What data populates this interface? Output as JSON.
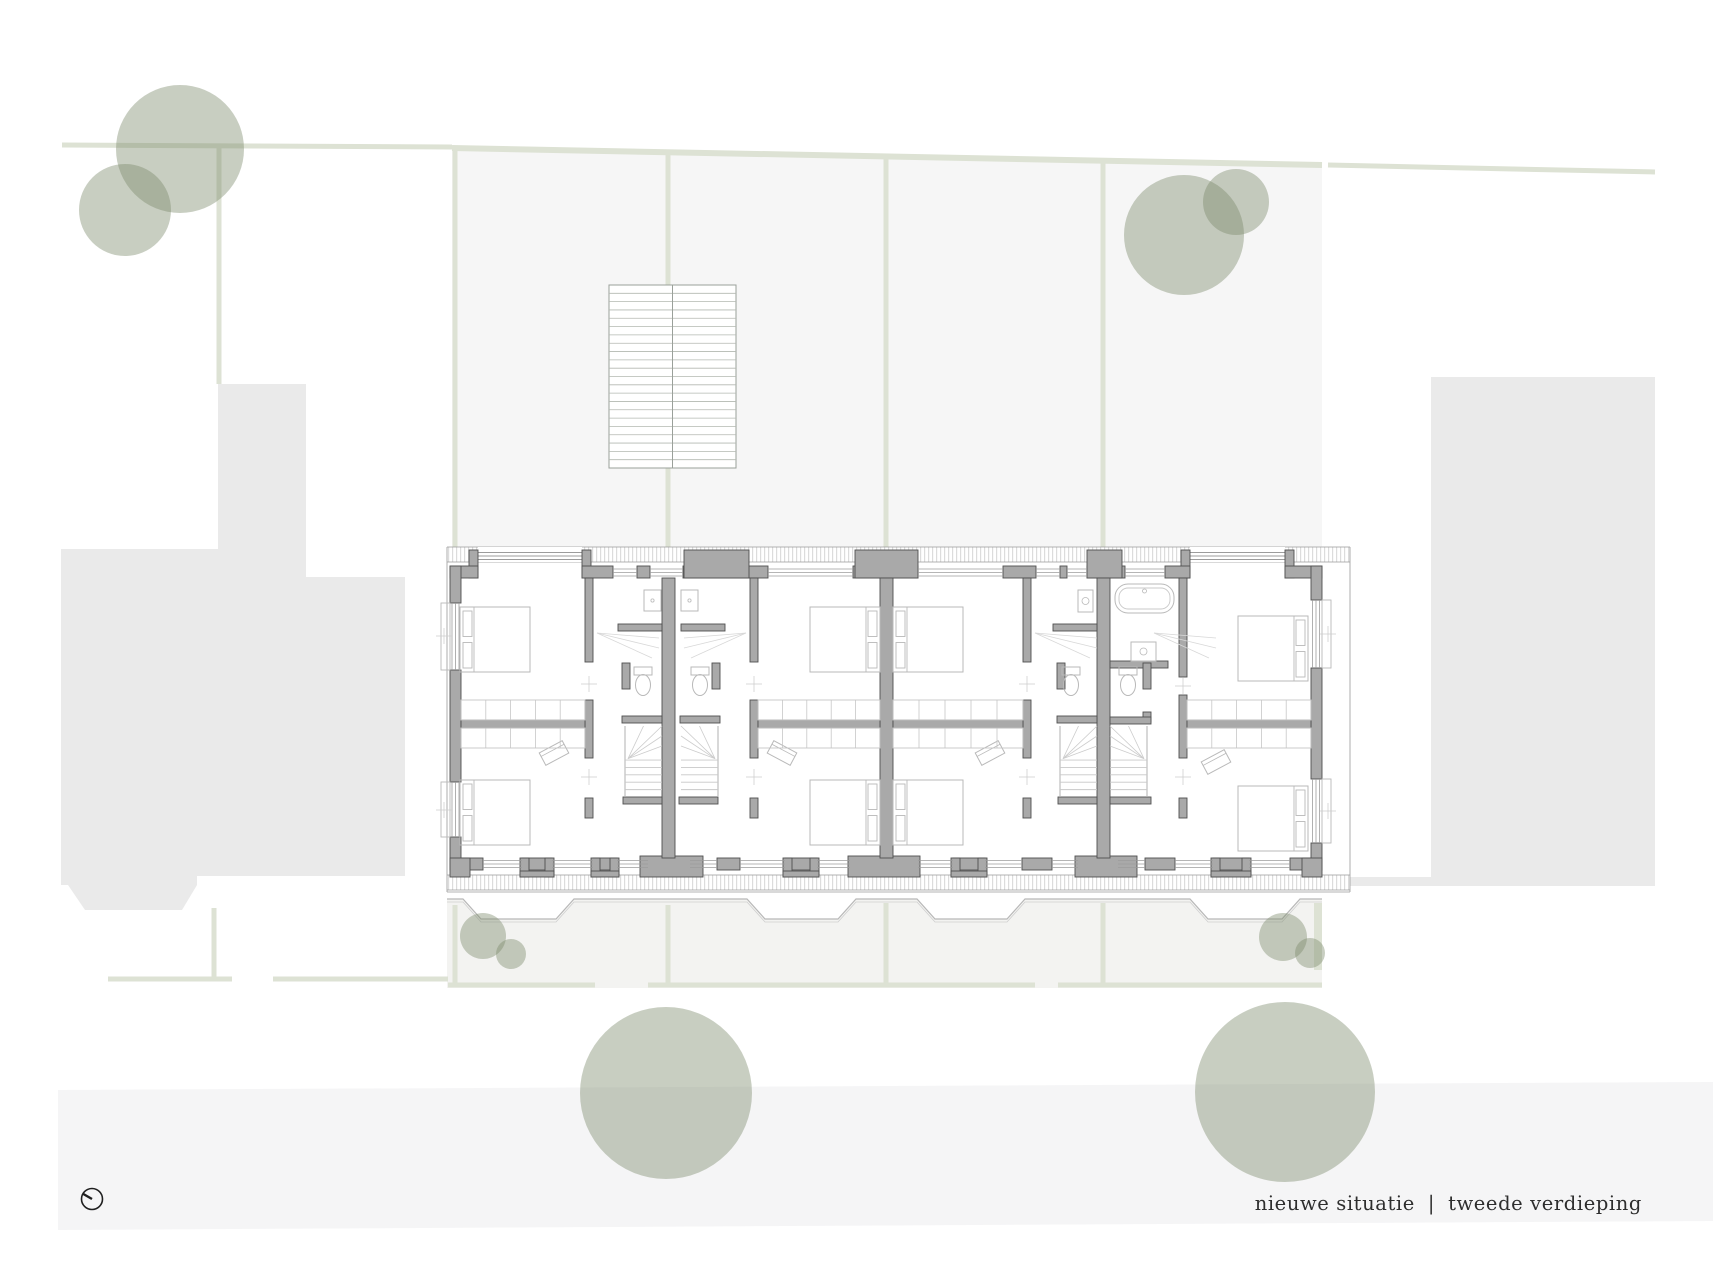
{
  "caption": {
    "left": "nieuwe situatie",
    "sep": "|",
    "right": "tweede verdieping"
  },
  "compass": {
    "cx": 92,
    "cy": 1199,
    "r": 10.5,
    "nx": -9.5,
    "ny": -5.5
  },
  "colors": {
    "plot_fill": "#f6f6f6",
    "building_fill": "#eaeaea",
    "road_fill": "#f5f5f6",
    "strip_fill": "#f3f3f1",
    "line_green": "#dde2d4",
    "tree_green": "rgba(124,139,107,0.42)",
    "wall_fill": "#a9a9a9",
    "wall_stroke": "#4f4f4f",
    "thin": "#b9b9b9",
    "thin2": "#9c9c9c",
    "hatch": "#d0d0d0",
    "text": "#2e2e2e"
  },
  "site": {
    "garden_polygon": [
      [
        452,
        148
      ],
      [
        1322,
        165
      ],
      [
        1322,
        547
      ],
      [
        452,
        547
      ]
    ],
    "left_building_polygon": [
      [
        61,
        549
      ],
      [
        218,
        549
      ],
      [
        218,
        384
      ],
      [
        306,
        384
      ],
      [
        306,
        577
      ],
      [
        405,
        577
      ],
      [
        405,
        876
      ],
      [
        197,
        876
      ],
      [
        197,
        885
      ],
      [
        182,
        910
      ],
      [
        85,
        910
      ],
      [
        68,
        885
      ],
      [
        61,
        885
      ]
    ],
    "right_building": {
      "x": 1431,
      "y": 377,
      "w": 224,
      "h": 509
    },
    "connector": {
      "x": 1328,
      "y": 877,
      "w": 103,
      "h": 9
    },
    "road_polygon": [
      [
        58,
        1090
      ],
      [
        1713,
        1082
      ],
      [
        1713,
        1221
      ],
      [
        58,
        1230
      ]
    ],
    "strip_zigzag": [
      [
        447,
        899
      ],
      [
        463,
        899
      ],
      [
        481,
        919
      ],
      [
        556,
        919
      ],
      [
        574,
        899
      ],
      [
        747,
        899
      ],
      [
        765,
        919
      ],
      [
        838,
        919
      ],
      [
        856,
        899
      ],
      [
        917,
        899
      ],
      [
        935,
        919
      ],
      [
        1007,
        919
      ],
      [
        1025,
        899
      ],
      [
        1190,
        899
      ],
      [
        1208,
        919
      ],
      [
        1282,
        919
      ],
      [
        1300,
        899
      ],
      [
        1322,
        899
      ]
    ],
    "strip_bottom_y": 988,
    "boundary_lines": [
      {
        "x1": 62,
        "y1": 145,
        "x2": 452,
        "y2": 147,
        "w": 5
      },
      {
        "x1": 219,
        "y1": 147,
        "x2": 219,
        "y2": 384,
        "w": 5
      },
      {
        "x1": 452,
        "y1": 148,
        "x2": 1322,
        "y2": 165,
        "w": 6
      },
      {
        "x1": 1328,
        "y1": 165,
        "x2": 1655,
        "y2": 172,
        "w": 5
      },
      {
        "x1": 455,
        "y1": 150,
        "x2": 455,
        "y2": 547,
        "w": 5
      },
      {
        "x1": 668,
        "y1": 152,
        "x2": 668,
        "y2": 285,
        "w": 5
      },
      {
        "x1": 668,
        "y1": 468,
        "x2": 668,
        "y2": 547,
        "w": 5
      },
      {
        "x1": 886,
        "y1": 156,
        "x2": 886,
        "y2": 547,
        "w": 5
      },
      {
        "x1": 1103,
        "y1": 160,
        "x2": 1103,
        "y2": 547,
        "w": 5
      },
      {
        "x1": 455,
        "y1": 905,
        "x2": 455,
        "y2": 985,
        "w": 5
      },
      {
        "x1": 668,
        "y1": 905,
        "x2": 668,
        "y2": 985,
        "w": 5
      },
      {
        "x1": 886,
        "y1": 903,
        "x2": 886,
        "y2": 985,
        "w": 5
      },
      {
        "x1": 1103,
        "y1": 903,
        "x2": 1103,
        "y2": 985,
        "w": 5
      },
      {
        "x1": 1318,
        "y1": 903,
        "x2": 1318,
        "y2": 970,
        "w": 8
      },
      {
        "x1": 448,
        "y1": 985,
        "x2": 595,
        "y2": 985,
        "w": 5
      },
      {
        "x1": 648,
        "y1": 985,
        "x2": 1035,
        "y2": 985,
        "w": 5
      },
      {
        "x1": 1058,
        "y1": 985,
        "x2": 1322,
        "y2": 985,
        "w": 5
      },
      {
        "x1": 108,
        "y1": 979,
        "x2": 232,
        "y2": 979,
        "w": 5
      },
      {
        "x1": 273,
        "y1": 979,
        "x2": 448,
        "y2": 979,
        "w": 5
      },
      {
        "x1": 214,
        "y1": 908,
        "x2": 214,
        "y2": 979,
        "w": 5
      }
    ],
    "ext_stair": {
      "x": 609,
      "y": 285,
      "w": 127,
      "h": 183,
      "treads": 22
    },
    "trees": [
      {
        "cx": 180,
        "cy": 149,
        "r": 64
      },
      {
        "cx": 125,
        "cy": 210,
        "r": 46
      },
      {
        "cx": 1184,
        "cy": 235,
        "r": 60
      },
      {
        "cx": 1236,
        "cy": 202,
        "r": 33
      },
      {
        "cx": 483,
        "cy": 936,
        "r": 23
      },
      {
        "cx": 511,
        "cy": 954,
        "r": 15
      },
      {
        "cx": 1283,
        "cy": 937,
        "r": 24
      },
      {
        "cx": 1310,
        "cy": 953,
        "r": 15
      },
      {
        "cx": 666,
        "cy": 1093,
        "r": 86
      },
      {
        "cx": 1285,
        "cy": 1092,
        "r": 90
      }
    ]
  },
  "plan": {
    "eaves": [
      {
        "x": 447,
        "y": 547,
        "w": 903,
        "h": 15
      },
      {
        "x": 447,
        "y": 875,
        "w": 903,
        "h": 15
      }
    ],
    "edge_lines": [
      {
        "x1": 447,
        "y1": 547,
        "x2": 1350,
        "y2": 547
      },
      {
        "x1": 447,
        "y1": 562,
        "x2": 1350,
        "y2": 562
      },
      {
        "x1": 447,
        "y1": 875,
        "x2": 1350,
        "y2": 875
      },
      {
        "x1": 447,
        "y1": 890,
        "x2": 1350,
        "y2": 890
      },
      {
        "x1": 447,
        "y1": 892,
        "x2": 1350,
        "y2": 892
      },
      {
        "x1": 447,
        "y1": 547,
        "x2": 447,
        "y2": 892
      },
      {
        "x1": 1350,
        "y1": 547,
        "x2": 1350,
        "y2": 892
      }
    ],
    "top_wall": {
      "y": 566,
      "h": 12,
      "segs": [
        [
          450,
          478
        ],
        [
          582,
          613
        ],
        [
          637,
          650
        ],
        [
          683,
          768
        ],
        [
          853,
          918
        ],
        [
          1003,
          1036
        ],
        [
          1060,
          1067
        ],
        [
          1087,
          1125
        ],
        [
          1165,
          1190
        ],
        [
          1285,
          1322
        ]
      ]
    },
    "bottom_wall": {
      "y": 858,
      "h": 12,
      "segs": [
        [
          450,
          483
        ],
        [
          522,
          552
        ],
        [
          593,
          617
        ],
        [
          648,
          690
        ],
        [
          717,
          740
        ],
        [
          785,
          817
        ],
        [
          850,
          918
        ],
        [
          953,
          985
        ],
        [
          1022,
          1052
        ],
        [
          1078,
          1118
        ],
        [
          1145,
          1175
        ],
        [
          1213,
          1249
        ],
        [
          1290,
          1322
        ]
      ]
    },
    "left_wall": {
      "x": 450,
      "w": 11,
      "segs": [
        [
          566,
          603
        ],
        [
          670,
          782
        ],
        [
          837,
          870
        ]
      ]
    },
    "right_wall": {
      "x": 1311,
      "w": 11,
      "segs": [
        [
          566,
          600
        ],
        [
          668,
          779
        ],
        [
          843,
          870
        ]
      ]
    },
    "party_walls": [
      {
        "x": 662,
        "y": 578,
        "w": 13,
        "h": 280
      },
      {
        "x": 880,
        "y": 578,
        "w": 13,
        "h": 280
      },
      {
        "x": 1097,
        "y": 578,
        "w": 13,
        "h": 280
      }
    ],
    "int_walls": [
      {
        "x": 585,
        "y": 578,
        "w": 8,
        "h": 84
      },
      {
        "x": 585,
        "y": 700,
        "w": 8,
        "h": 58
      },
      {
        "x": 585,
        "y": 798,
        "w": 8,
        "h": 20
      },
      {
        "x": 750,
        "y": 578,
        "w": 8,
        "h": 84
      },
      {
        "x": 750,
        "y": 700,
        "w": 8,
        "h": 58
      },
      {
        "x": 750,
        "y": 798,
        "w": 8,
        "h": 20
      },
      {
        "x": 1023,
        "y": 578,
        "w": 8,
        "h": 84
      },
      {
        "x": 1023,
        "y": 700,
        "w": 8,
        "h": 58
      },
      {
        "x": 1023,
        "y": 798,
        "w": 8,
        "h": 20
      },
      {
        "x": 1179,
        "y": 578,
        "w": 8,
        "h": 99
      },
      {
        "x": 1179,
        "y": 695,
        "w": 8,
        "h": 63
      },
      {
        "x": 1179,
        "y": 798,
        "w": 8,
        "h": 20
      },
      {
        "x": 461,
        "y": 720,
        "w": 124,
        "h": 8
      },
      {
        "x": 758,
        "y": 720,
        "w": 122,
        "h": 8
      },
      {
        "x": 893,
        "y": 720,
        "w": 130,
        "h": 8
      },
      {
        "x": 1187,
        "y": 720,
        "w": 124,
        "h": 8
      },
      {
        "x": 618,
        "y": 624,
        "w": 44,
        "h": 7
      },
      {
        "x": 681,
        "y": 624,
        "w": 44,
        "h": 7
      },
      {
        "x": 1053,
        "y": 624,
        "w": 44,
        "h": 7
      },
      {
        "x": 1110,
        "y": 661,
        "w": 58,
        "h": 7
      },
      {
        "x": 622,
        "y": 663,
        "w": 8,
        "h": 26
      },
      {
        "x": 622,
        "y": 716,
        "w": 40,
        "h": 7
      },
      {
        "x": 712,
        "y": 663,
        "w": 8,
        "h": 26
      },
      {
        "x": 680,
        "y": 716,
        "w": 40,
        "h": 7
      },
      {
        "x": 1057,
        "y": 663,
        "w": 8,
        "h": 26
      },
      {
        "x": 1057,
        "y": 716,
        "w": 40,
        "h": 7
      },
      {
        "x": 1143,
        "y": 663,
        "w": 8,
        "h": 26
      },
      {
        "x": 1143,
        "y": 712,
        "w": 8,
        "h": 10
      },
      {
        "x": 1110,
        "y": 717,
        "w": 41,
        "h": 7
      },
      {
        "x": 623,
        "y": 797,
        "w": 39,
        "h": 7
      },
      {
        "x": 679,
        "y": 797,
        "w": 39,
        "h": 7
      },
      {
        "x": 1058,
        "y": 797,
        "w": 39,
        "h": 7
      },
      {
        "x": 1110,
        "y": 797,
        "w": 41,
        "h": 7
      }
    ],
    "chimneys_top": [
      {
        "x": 684,
        "y": 550,
        "w": 65,
        "h": 28
      },
      {
        "x": 855,
        "y": 550,
        "w": 63,
        "h": 28
      },
      {
        "x": 1087,
        "y": 550,
        "w": 35,
        "h": 28
      }
    ],
    "chimneys_bottom": [
      {
        "x": 640,
        "y": 856,
        "w": 63,
        "h": 21
      },
      {
        "x": 848,
        "y": 856,
        "w": 72,
        "h": 21
      },
      {
        "x": 1075,
        "y": 856,
        "w": 62,
        "h": 21
      }
    ],
    "end_stubs": [
      {
        "x": 450,
        "y": 858,
        "w": 20,
        "h": 19
      },
      {
        "x": 1302,
        "y": 858,
        "w": 20,
        "h": 19
      }
    ],
    "piers_bottom": [
      [
        520,
        554
      ],
      [
        591,
        619
      ],
      [
        783,
        819
      ],
      [
        951,
        987
      ],
      [
        1211,
        1251
      ]
    ],
    "dormers": [
      {
        "x": 478,
        "w": 104
      },
      {
        "x": 1190,
        "w": 95
      }
    ],
    "top_windows": [
      [
        613,
        637
      ],
      [
        650,
        683
      ],
      [
        768,
        853
      ],
      [
        918,
        1003
      ],
      [
        1036,
        1060
      ],
      [
        1067,
        1087
      ],
      [
        1125,
        1165
      ]
    ],
    "bottom_windows": [
      [
        483,
        522
      ],
      [
        552,
        593
      ],
      [
        617,
        648
      ],
      [
        690,
        717
      ],
      [
        740,
        785
      ],
      [
        817,
        850
      ],
      [
        918,
        953
      ],
      [
        985,
        1022
      ],
      [
        1052,
        1078
      ],
      [
        1118,
        1145
      ],
      [
        1175,
        1213
      ],
      [
        1249,
        1290
      ]
    ],
    "left_windows": [
      [
        603,
        670
      ],
      [
        782,
        837
      ]
    ],
    "right_windows": [
      [
        600,
        668
      ],
      [
        779,
        843
      ]
    ],
    "sills": [
      {
        "x": 441,
        "y": 603,
        "w": 9,
        "h": 67
      },
      {
        "x": 441,
        "y": 782,
        "w": 9,
        "h": 55
      },
      {
        "x": 1322,
        "y": 600,
        "w": 9,
        "h": 68
      },
      {
        "x": 1322,
        "y": 779,
        "w": 9,
        "h": 64
      }
    ],
    "beds": [
      {
        "x": 460,
        "y": 607,
        "w": 70,
        "h": 65,
        "head": "left"
      },
      {
        "x": 460,
        "y": 780,
        "w": 70,
        "h": 65,
        "head": "left"
      },
      {
        "x": 810,
        "y": 607,
        "w": 70,
        "h": 65,
        "head": "right"
      },
      {
        "x": 810,
        "y": 780,
        "w": 70,
        "h": 65,
        "head": "right"
      },
      {
        "x": 893,
        "y": 607,
        "w": 70,
        "h": 65,
        "head": "left"
      },
      {
        "x": 893,
        "y": 780,
        "w": 70,
        "h": 65,
        "head": "left"
      },
      {
        "x": 1238,
        "y": 616,
        "w": 70,
        "h": 65,
        "head": "right"
      },
      {
        "x": 1238,
        "y": 786,
        "w": 70,
        "h": 65,
        "head": "right"
      }
    ],
    "desks": [
      {
        "cx": 554,
        "cy": 753,
        "rot": -28
      },
      {
        "cx": 782,
        "cy": 753,
        "rot": 28
      },
      {
        "cx": 990,
        "cy": 753,
        "rot": -28
      },
      {
        "cx": 1216,
        "cy": 762,
        "rot": -28
      }
    ],
    "closets": [
      {
        "x": 461,
        "y": 700,
        "w": 124,
        "h": 20
      },
      {
        "x": 461,
        "y": 728,
        "w": 124,
        "h": 20
      },
      {
        "x": 758,
        "y": 700,
        "w": 122,
        "h": 20
      },
      {
        "x": 758,
        "y": 728,
        "w": 122,
        "h": 20
      },
      {
        "x": 893,
        "y": 700,
        "w": 130,
        "h": 20
      },
      {
        "x": 893,
        "y": 728,
        "w": 130,
        "h": 20
      },
      {
        "x": 1187,
        "y": 700,
        "w": 124,
        "h": 20
      },
      {
        "x": 1187,
        "y": 728,
        "w": 124,
        "h": 20
      }
    ],
    "toilets": [
      {
        "cx": 643,
        "cy": 684
      },
      {
        "cx": 700,
        "cy": 684
      },
      {
        "cx": 1071,
        "cy": 684
      },
      {
        "cx": 1128,
        "cy": 684
      }
    ],
    "showers": [
      {
        "x": 644,
        "y": 590,
        "w": 17,
        "h": 21
      },
      {
        "x": 681,
        "y": 590,
        "w": 17,
        "h": 21
      }
    ],
    "basins": [
      {
        "x": 1078,
        "y": 590,
        "w": 15,
        "h": 22
      },
      {
        "x": 1131,
        "y": 642,
        "w": 25,
        "h": 19
      }
    ],
    "tub": {
      "x": 1115,
      "y": 584,
      "w": 59,
      "h": 29
    },
    "stairs": [
      {
        "x": 625,
        "y": 726,
        "w": 37,
        "h": 71,
        "conv": "left"
      },
      {
        "x": 681,
        "y": 726,
        "w": 37,
        "h": 71,
        "conv": "right"
      },
      {
        "x": 1060,
        "y": 726,
        "w": 37,
        "h": 71,
        "conv": "left"
      },
      {
        "x": 1110,
        "y": 726,
        "w": 37,
        "h": 71,
        "conv": "right"
      }
    ],
    "fans": [
      {
        "px": 597,
        "py": 633,
        "dir": 1
      },
      {
        "px": 746,
        "py": 633,
        "dir": -1
      },
      {
        "px": 1035,
        "py": 633,
        "dir": 1
      },
      {
        "px": 1154,
        "py": 633,
        "dir": 1
      }
    ],
    "ticks": [
      {
        "x": 444,
        "y": 636
      },
      {
        "x": 444,
        "y": 810
      },
      {
        "x": 1328,
        "y": 634
      },
      {
        "x": 1328,
        "y": 811
      },
      {
        "x": 589,
        "y": 684
      },
      {
        "x": 589,
        "y": 777
      },
      {
        "x": 754,
        "y": 684
      },
      {
        "x": 754,
        "y": 777
      },
      {
        "x": 1027,
        "y": 684
      },
      {
        "x": 1027,
        "y": 777
      },
      {
        "x": 1183,
        "y": 686
      },
      {
        "x": 1183,
        "y": 777
      }
    ]
  }
}
